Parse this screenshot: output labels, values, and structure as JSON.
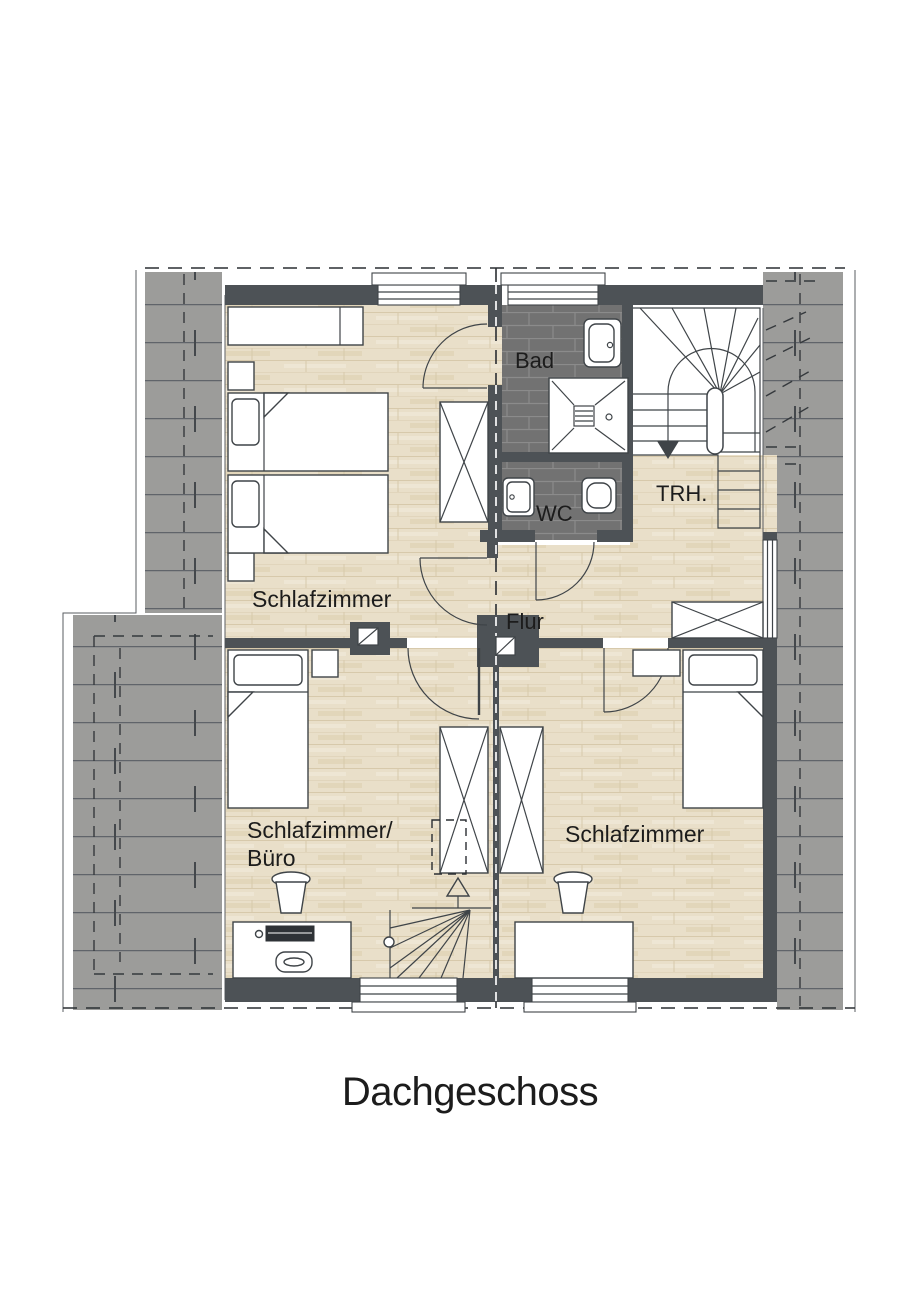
{
  "title": "Dachgeschoss",
  "rooms": {
    "bedroom_top_left": {
      "label": "Schlafzimmer"
    },
    "bathroom": {
      "label": "Bad"
    },
    "wc": {
      "label": "WC"
    },
    "stairwell": {
      "label": "TRH."
    },
    "hallway": {
      "label": "Flur"
    },
    "bedroom_office": {
      "label_line1": "Schlafzimmer/",
      "label_line2": "Büro"
    },
    "bedroom_bottom_right": {
      "label": "Schlafzimmer"
    }
  },
  "colors": {
    "wall": "#4d5256",
    "wood_floor": "#e9dfc9",
    "wood_line": "#d7c9ab",
    "tile_dark": "#727272",
    "tile_grout": "#8b8b8b",
    "roof_fill": "#9c9c9a",
    "roof_line": "#60646a",
    "outline": "#3f4448",
    "background": "#ffffff",
    "text": "#1c1c1c"
  }
}
